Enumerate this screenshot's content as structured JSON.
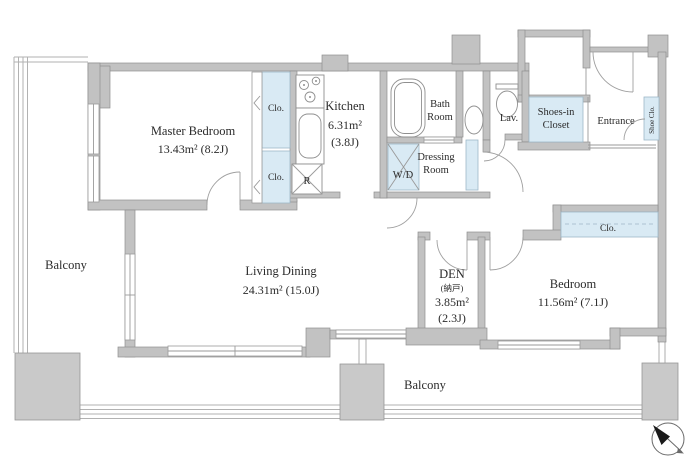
{
  "document": {
    "type": "apartment-floor-plan"
  },
  "colors": {
    "wall": "#c2c2c2",
    "wall_outline": "#8f8f8f",
    "closet_fill": "#d9eaf4",
    "background": "#ffffff",
    "text": "#2b2b2b",
    "compass_needle": "#1a1a1a"
  },
  "labels": {
    "master_bedroom": {
      "name": "Master Bedroom",
      "area": "13.43m² (8.2J)"
    },
    "living_dining": {
      "name": "Living Dining",
      "area": "24.31m² (15.0J)"
    },
    "kitchen": {
      "name": "Kitchen",
      "area": "6.31m²",
      "tatami": "(3.8J)"
    },
    "bath_room": {
      "line1": "Bath",
      "line2": "Room"
    },
    "lavatory": {
      "name": "Lav."
    },
    "dressing_room": {
      "line1": "Dressing",
      "line2": "Room"
    },
    "washer_dryer": {
      "name": "W/D"
    },
    "refrigerator": {
      "name": "R"
    },
    "den": {
      "name": "DEN",
      "japanese": "(納戸)",
      "area": "3.85m²",
      "tatami": "(2.3J)"
    },
    "bedroom": {
      "name": "Bedroom",
      "area": "11.56m² (7.1J)"
    },
    "entrance": {
      "name": "Entrance"
    },
    "shoes_in_closet": {
      "line1": "Shoes-in",
      "line2": "Closet"
    },
    "shoe_closet": {
      "name": "Shoe Clo."
    },
    "closet_master_upper": "Clo.",
    "closet_master_lower": "Clo.",
    "closet_bedroom": "Clo.",
    "balcony_left": "Balcony",
    "balcony_bottom": "Balcony"
  }
}
